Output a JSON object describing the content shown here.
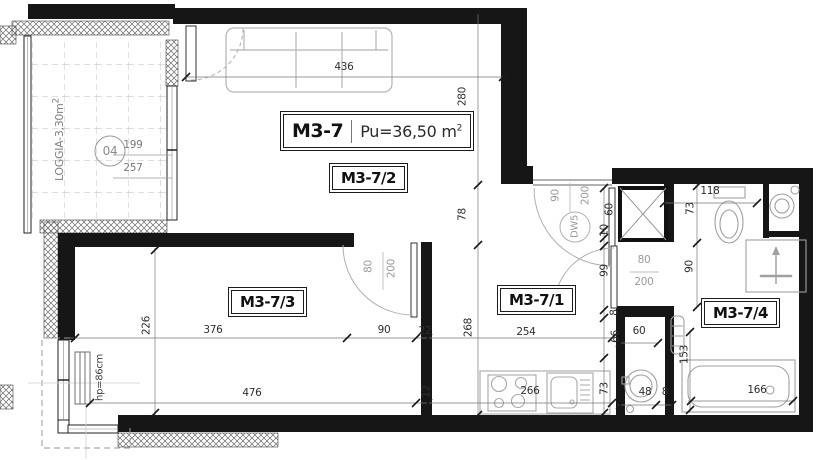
{
  "title": {
    "unit": "M3-7",
    "area": "Pu=36,50 m",
    "area_sup": "2"
  },
  "rooms": {
    "living": "M3-7/2",
    "bedroom": "M3-7/3",
    "hall": "M3-7/1",
    "bathroom": "M3-7/4"
  },
  "loggia": {
    "label": "LOGGIA-3,30m",
    "label_sup": "2",
    "marker": "04",
    "dim_w": "199",
    "dim_h": "257"
  },
  "entry_door": {
    "id": "DW5",
    "width": "90",
    "height": "200"
  },
  "bedroom_door": {
    "width": "80",
    "height": "200"
  },
  "bathroom_door": {
    "width": "80",
    "height": "200"
  },
  "radiator_note": "hp=86cm",
  "dims": {
    "living_top": "436",
    "living_right_a": "280",
    "living_right_b": "78",
    "hall_right": "268",
    "bedroom_left": "226",
    "bedroom_w1": "376",
    "bedroom_w2": "90",
    "wall_22": "22",
    "bedroom_total": "476",
    "wall_12": "12",
    "hall_w": "254",
    "kitchen_run": "266",
    "kitchen_66": "66",
    "kitchen_73": "73",
    "entry_60": "60",
    "entry_10": "10",
    "entry_99": "99",
    "entry_8": "8",
    "bath_top": "118",
    "bath_73": "73",
    "bath_90": "90",
    "bath_153": "153",
    "tub_166": "166",
    "niche_60": "60",
    "wm_48": "48",
    "wm_8": "8"
  }
}
